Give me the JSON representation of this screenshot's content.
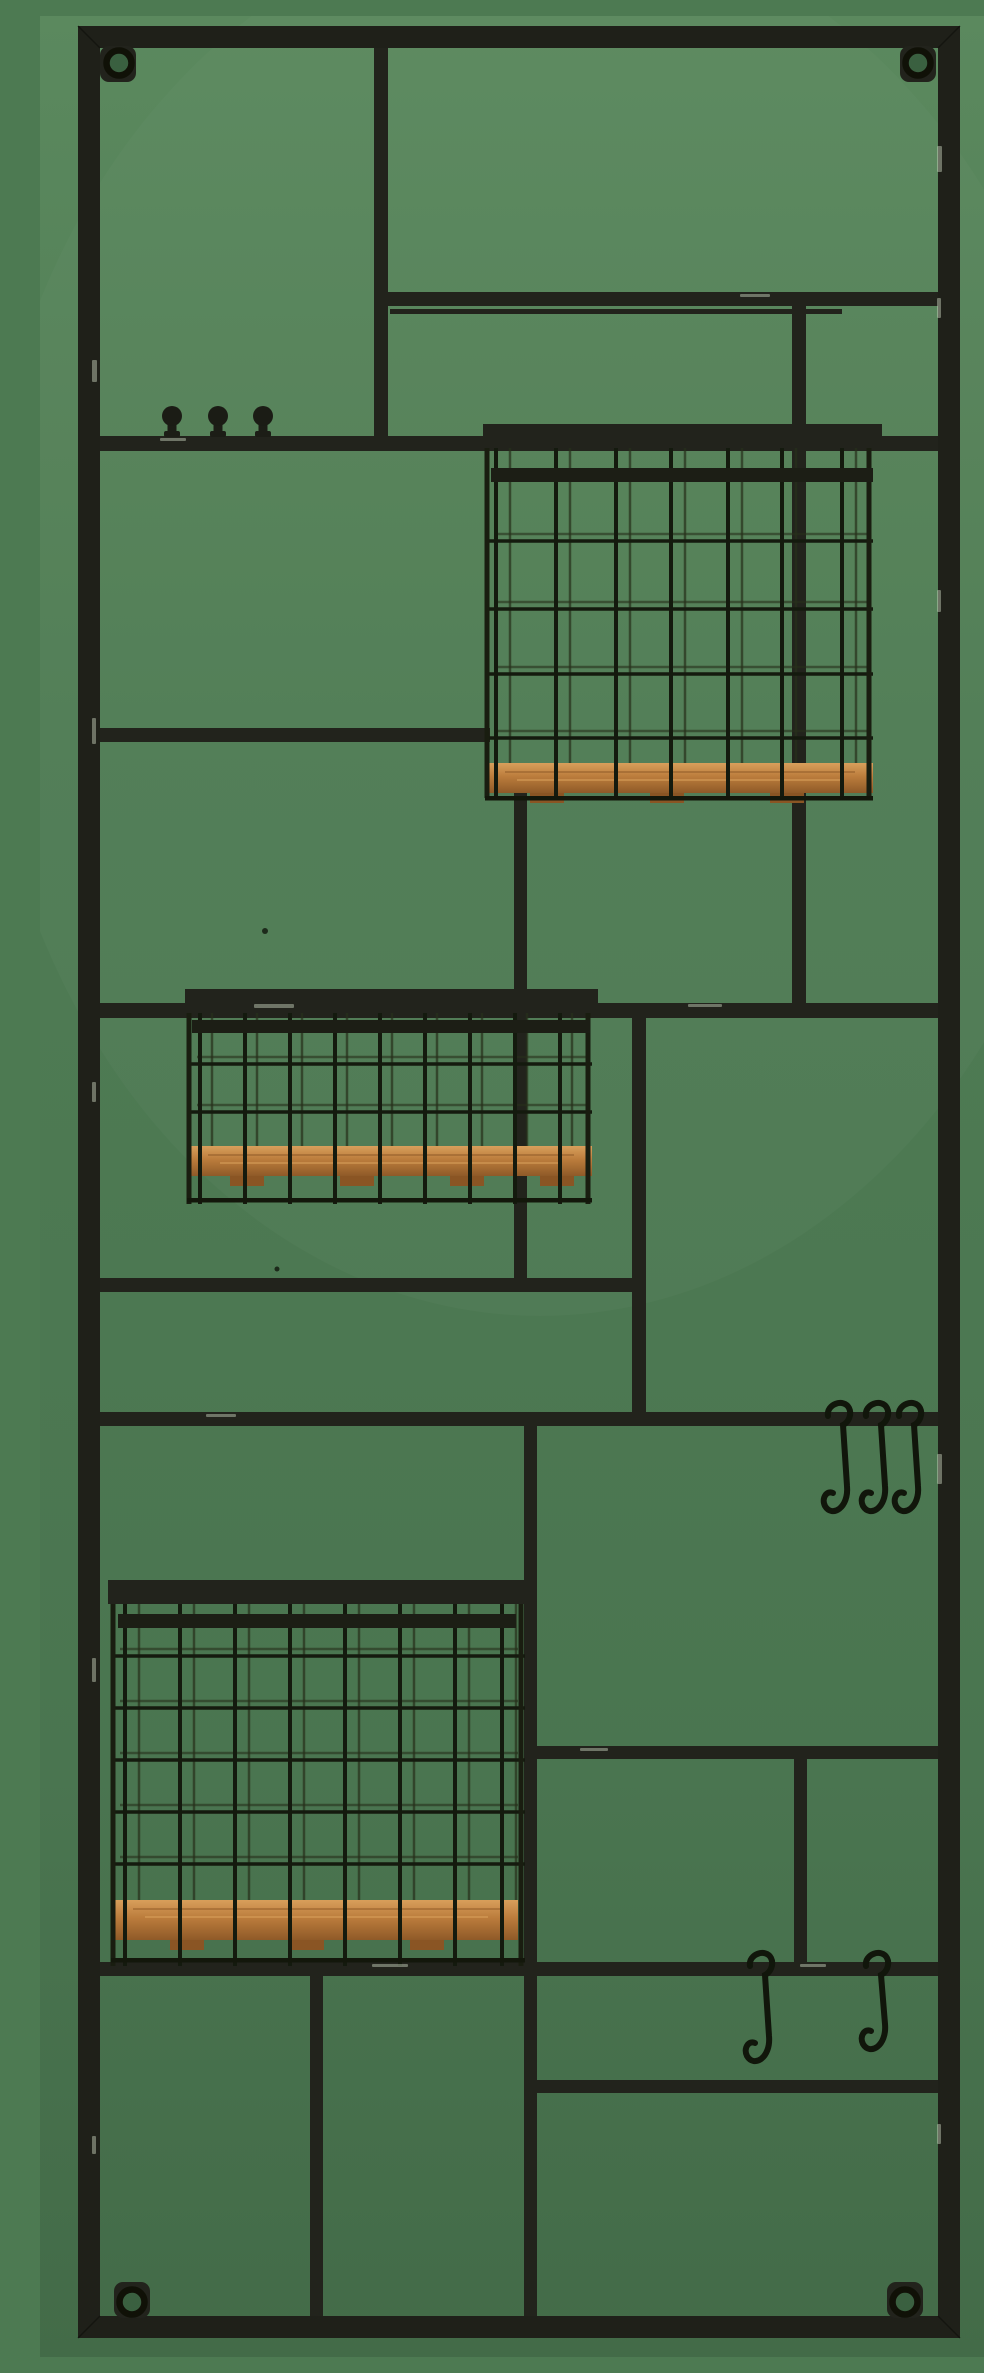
{
  "image": {
    "type": "product-photo",
    "subject": "Black metal modular wall organizer rack with three wire baskets with wooden shelf bottoms, three coat knobs and five S-hooks, mounted on a green wall",
    "canvas": {
      "width": 984,
      "height": 2341
    },
    "palette": {
      "wall_top": "#5b895e",
      "wall_mid": "#4e7b53",
      "wall_bottom": "#436b48",
      "metal": "#22231c",
      "metal_dark": "#15160f",
      "seam": "#0d0e09",
      "wire": "#141a0e",
      "wire_back": "#27301b",
      "wood_light": "#dca45e",
      "wood": "#bb7c3c",
      "wood_dark": "#8a5524",
      "chip": "#cfd9c4",
      "hole_green": "#3a6040",
      "hook": "#11160b"
    }
  },
  "rack": {
    "frame": {
      "left": 38,
      "top": 10,
      "right": 920,
      "bottom": 2322,
      "thickness": 22
    },
    "eyelets": [
      {
        "name": "top-left-screw",
        "cx": 79,
        "cy": 47,
        "tab": [
          60,
          30,
          36,
          36
        ]
      },
      {
        "name": "top-right-screw",
        "cx": 878,
        "cy": 47,
        "tab": [
          860,
          30,
          36,
          36
        ]
      },
      {
        "name": "bottom-left-screw",
        "cx": 92,
        "cy": 2286,
        "tab": [
          74,
          2266,
          36,
          36
        ]
      },
      {
        "name": "bottom-right-screw",
        "cx": 865,
        "cy": 2286,
        "tab": [
          847,
          2266,
          36,
          36
        ]
      }
    ],
    "bars": [
      {
        "name": "divider-top",
        "x": 334,
        "y": 32,
        "w": 14,
        "h": 395
      },
      {
        "name": "shelf-top-right",
        "x": 341,
        "y": 276,
        "w": 557,
        "h": 14
      },
      {
        "name": "shelf-top-right-lip",
        "x": 350,
        "y": 293,
        "w": 452,
        "h": 5
      },
      {
        "name": "knob-rail",
        "x": 60,
        "y": 420,
        "w": 838,
        "h": 15
      },
      {
        "name": "shelf-mid-left",
        "x": 60,
        "y": 712,
        "w": 390,
        "h": 14
      },
      {
        "name": "post-under-basket-one",
        "x": 474,
        "y": 768,
        "w": 13,
        "h": 504
      },
      {
        "name": "post-behind-basket-one",
        "x": 752,
        "y": 290,
        "w": 14,
        "h": 702
      },
      {
        "name": "shelf-middle-full",
        "x": 60,
        "y": 987,
        "w": 838,
        "h": 15
      },
      {
        "name": "post-middle",
        "x": 592,
        "y": 1002,
        "w": 14,
        "h": 396
      },
      {
        "name": "shelf-under-basket-two",
        "x": 60,
        "y": 1262,
        "w": 546,
        "h": 14
      },
      {
        "name": "hook-rail-upper",
        "x": 60,
        "y": 1396,
        "w": 838,
        "h": 14
      },
      {
        "name": "post-right-of-basket-three",
        "x": 484,
        "y": 1410,
        "w": 13,
        "h": 890
      },
      {
        "name": "shelf-lower-right",
        "x": 488,
        "y": 1730,
        "w": 410,
        "h": 13
      },
      {
        "name": "post-lower-right",
        "x": 754,
        "y": 1743,
        "w": 13,
        "h": 205
      },
      {
        "name": "hook-rail-lower",
        "x": 60,
        "y": 1946,
        "w": 838,
        "h": 14
      },
      {
        "name": "shelf-bottom-right",
        "x": 490,
        "y": 2064,
        "w": 408,
        "h": 13
      },
      {
        "name": "post-bottom-left",
        "x": 270,
        "y": 1960,
        "w": 13,
        "h": 340
      }
    ],
    "knobs": {
      "rail_y": 420,
      "xs": [
        132,
        178,
        223
      ]
    },
    "s_hooks": [
      {
        "name": "s-hook-upper-1",
        "x": 800,
        "top": 1394,
        "len": 110
      },
      {
        "name": "s-hook-upper-2",
        "x": 838,
        "top": 1394,
        "len": 110
      },
      {
        "name": "s-hook-upper-3",
        "x": 871,
        "top": 1394,
        "len": 110
      },
      {
        "name": "s-hook-lower-1",
        "x": 722,
        "top": 1944,
        "len": 110
      },
      {
        "name": "s-hook-lower-2",
        "x": 838,
        "top": 1944,
        "len": 98
      }
    ],
    "baskets": [
      {
        "name": "basket-top",
        "x": 443,
        "w": 399,
        "rail": {
          "y": 408,
          "h": 24
        },
        "lip": {
          "x": 451,
          "y": 452,
          "w": 382,
          "h": 14
        },
        "posts": [
          447,
          829
        ],
        "cols": [
          456,
          516,
          576,
          631,
          688,
          742,
          802
        ],
        "rows": [
          525,
          593,
          658,
          722
        ],
        "back_dx": 14,
        "cage_bottom": 782,
        "plank": {
          "x": 447,
          "y": 747,
          "w": 386,
          "h": 30
        },
        "feet_xs": [
          490,
          610,
          730
        ],
        "rim_y": 780
      },
      {
        "name": "basket-middle",
        "x": 145,
        "w": 413,
        "rail": {
          "y": 973,
          "h": 24
        },
        "lip": {
          "x": 152,
          "y": 1004,
          "w": 398,
          "h": 13
        },
        "posts": [
          149,
          548
        ],
        "cols": [
          160,
          205,
          250,
          295,
          340,
          385,
          430,
          475,
          520
        ],
        "rows": [
          1048,
          1096
        ],
        "back_dx": 12,
        "cage_bottom": 1188,
        "plank": {
          "x": 150,
          "y": 1130,
          "w": 402,
          "h": 30
        },
        "feet_xs": [
          190,
          300,
          410,
          500
        ],
        "rim_y": 1182
      },
      {
        "name": "basket-bottom",
        "x": 68,
        "w": 422,
        "rail": {
          "y": 1564,
          "h": 24
        },
        "lip": {
          "x": 78,
          "y": 1598,
          "w": 398,
          "h": 14
        },
        "posts": [
          73,
          481
        ],
        "cols": [
          85,
          140,
          195,
          250,
          305,
          360,
          415,
          462
        ],
        "rows": [
          1640,
          1692,
          1744,
          1796,
          1848
        ],
        "back_dx": 14,
        "cage_bottom": 1950,
        "plank": {
          "x": 75,
          "y": 1884,
          "w": 403,
          "h": 40
        },
        "feet_xs": [
          130,
          250,
          370
        ],
        "rim_y": 1942
      }
    ],
    "specks": [
      {
        "cx": 225,
        "cy": 915,
        "r": 3
      },
      {
        "cx": 237,
        "cy": 1253,
        "r": 2.5
      }
    ],
    "chips": [
      [
        52,
        344,
        5,
        22
      ],
      [
        52,
        702,
        4,
        26
      ],
      [
        52,
        1066,
        4,
        20
      ],
      [
        52,
        1642,
        4,
        24
      ],
      [
        52,
        2120,
        4,
        18
      ],
      [
        897,
        130,
        5,
        26
      ],
      [
        897,
        282,
        4,
        20
      ],
      [
        897,
        574,
        4,
        22
      ],
      [
        897,
        1438,
        5,
        30
      ],
      [
        897,
        2108,
        4,
        20
      ],
      [
        214,
        988,
        40,
        4
      ],
      [
        648,
        988,
        34,
        3
      ],
      [
        166,
        1398,
        30,
        3
      ],
      [
        332,
        1948,
        36,
        3
      ],
      [
        700,
        278,
        30,
        3
      ],
      [
        540,
        1732,
        28,
        3
      ],
      [
        120,
        422,
        26,
        3
      ],
      [
        760,
        1948,
        26,
        3
      ]
    ]
  }
}
